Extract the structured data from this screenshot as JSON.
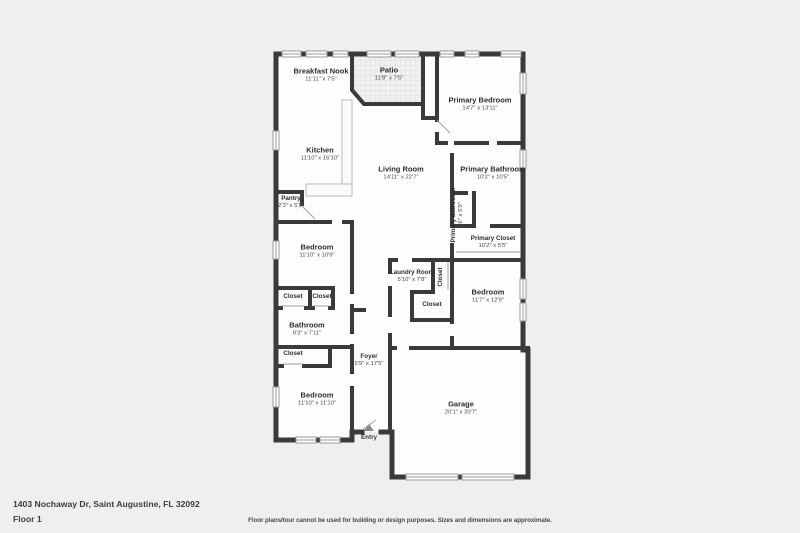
{
  "meta": {
    "type": "real-estate floor plan",
    "colors": {
      "background": "#f0efee",
      "walls": "#3a3a3a",
      "floor": "#fdfdfc",
      "patio_tile": "#f1f1f0"
    }
  },
  "footer": {
    "address": "1403 Nochaway Dr, Saint Augustine, FL 32092",
    "floor_label": "Floor 1",
    "disclaimer": "Floor plans/tour cannot be used for building or design purposes. Sizes and dimensions are approximate."
  },
  "entry": {
    "label": "Entry"
  },
  "rooms": [
    {
      "name": "Breakfast Nook",
      "dims": "11'11\" x 7'5\""
    },
    {
      "name": "Patio",
      "dims": "11'8\" x 7'5\""
    },
    {
      "name": "Primary Bedroom",
      "dims": "14'7\" x 13'11\""
    },
    {
      "name": "Kitchen",
      "dims": "11'10\" x 16'10\""
    },
    {
      "name": "Living Room",
      "dims": "14'11\" x 22'7\""
    },
    {
      "name": "Primary Bathroom",
      "dims": "10'2\" x 10'5\""
    },
    {
      "name": "Pantry",
      "dims": "2'3\" x 5'9\""
    },
    {
      "name": "Bedroom",
      "dims": "11'10\" x 10'9\""
    },
    {
      "name": "Primary Bathroom",
      "dims": "2'6\" x 5'9\""
    },
    {
      "name": "Primary Closet",
      "dims": "10'2\" x 5'5\""
    },
    {
      "name": "Laundry Room",
      "dims": "5'10\" x 7'8\""
    },
    {
      "name": "Closet"
    },
    {
      "name": "Bedroom",
      "dims": "11'7\" x 12'9\""
    },
    {
      "name": "Closet"
    },
    {
      "name": "Closet"
    },
    {
      "name": "Closet"
    },
    {
      "name": "Bathroom",
      "dims": "8'3\" x 7'11\""
    },
    {
      "name": "Closet"
    },
    {
      "name": "Foyer",
      "dims": "5'9\" x 17'5\""
    },
    {
      "name": "Bedroom",
      "dims": "11'10\" x 11'10\""
    },
    {
      "name": "Garage",
      "dims": "20'1\" x 20'7\""
    }
  ]
}
